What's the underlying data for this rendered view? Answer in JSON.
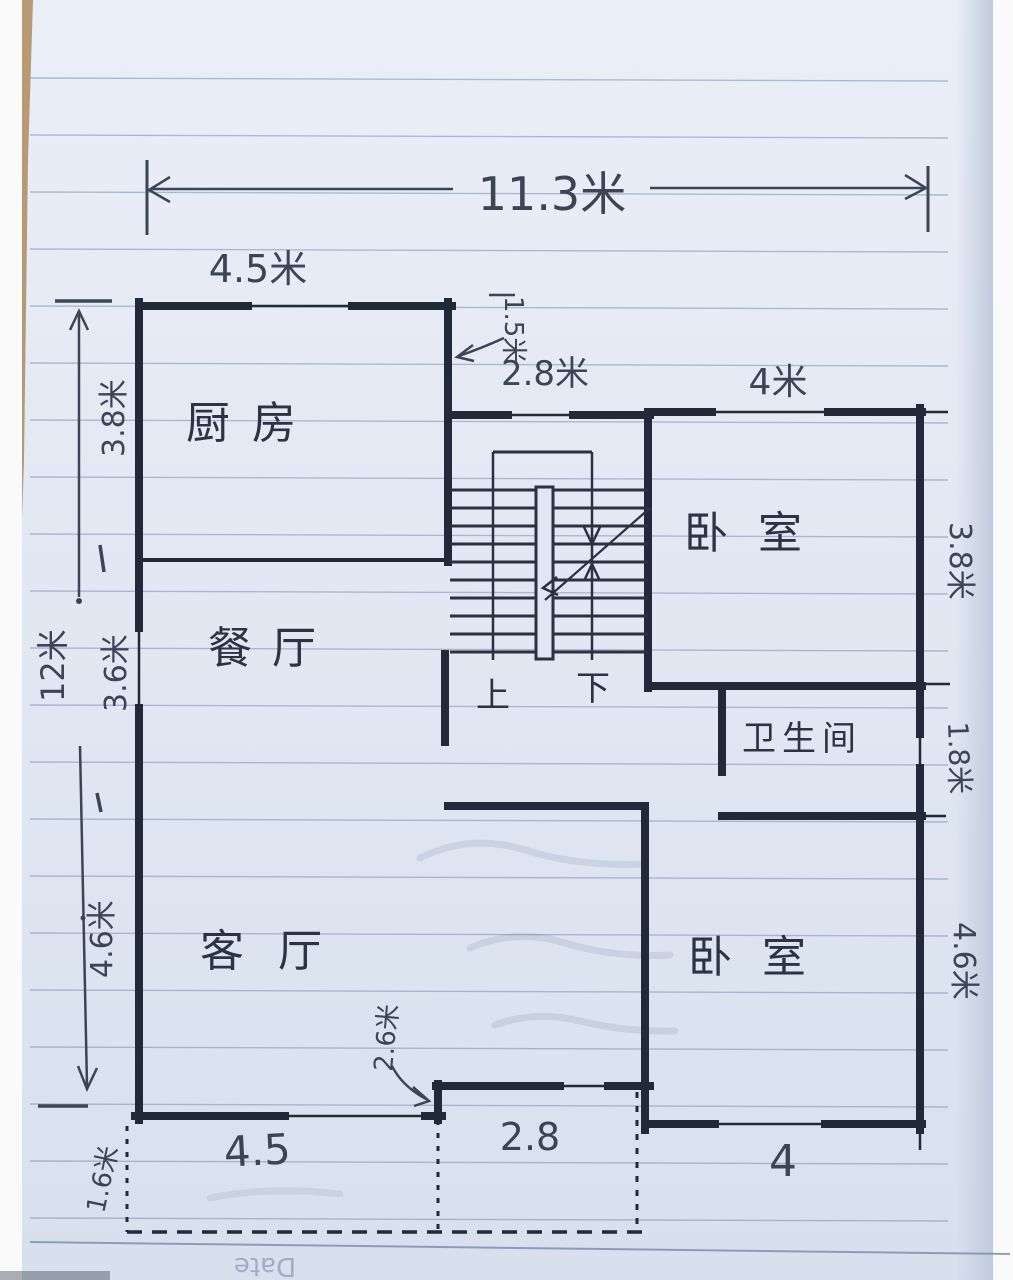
{
  "rooms": {
    "kitchen": {
      "label": "厨房"
    },
    "dining": {
      "label": "餐厅"
    },
    "living": {
      "label": "客厅"
    },
    "bedroom_top": {
      "label": "卧室"
    },
    "bedroom_bottom": {
      "label": "卧室"
    },
    "bathroom": {
      "label": "卫生间"
    }
  },
  "stairs": {
    "up_label": "上",
    "down_label": "下"
  },
  "dims": {
    "total_width": "11.3米",
    "kitchen_width": "4.5米",
    "kitchen_depth": "3.8米",
    "total_depth": "12米",
    "dining_depth": "3.6米",
    "living_depth": "4.6米",
    "porch_depth": "1.6米",
    "stair_landing": "1.5米",
    "stair_hall_width": "2.8米",
    "bedroom_top_width": "4米",
    "bedroom_top_depth": "3.8米",
    "bathroom_depth": "1.8米",
    "bedroom_bottom_depth": "4.6米",
    "entry_step_width": "2.6米",
    "bottom_living_width": "4.5",
    "bottom_porch_width": "2.8",
    "bottom_bedroom_width": "4"
  },
  "watermark": {
    "date": "Date"
  },
  "colors": {
    "ink": "#222938",
    "pen": "#3d4456",
    "paper": "#e2e8f3",
    "rule_line": "#7d8fb2"
  }
}
